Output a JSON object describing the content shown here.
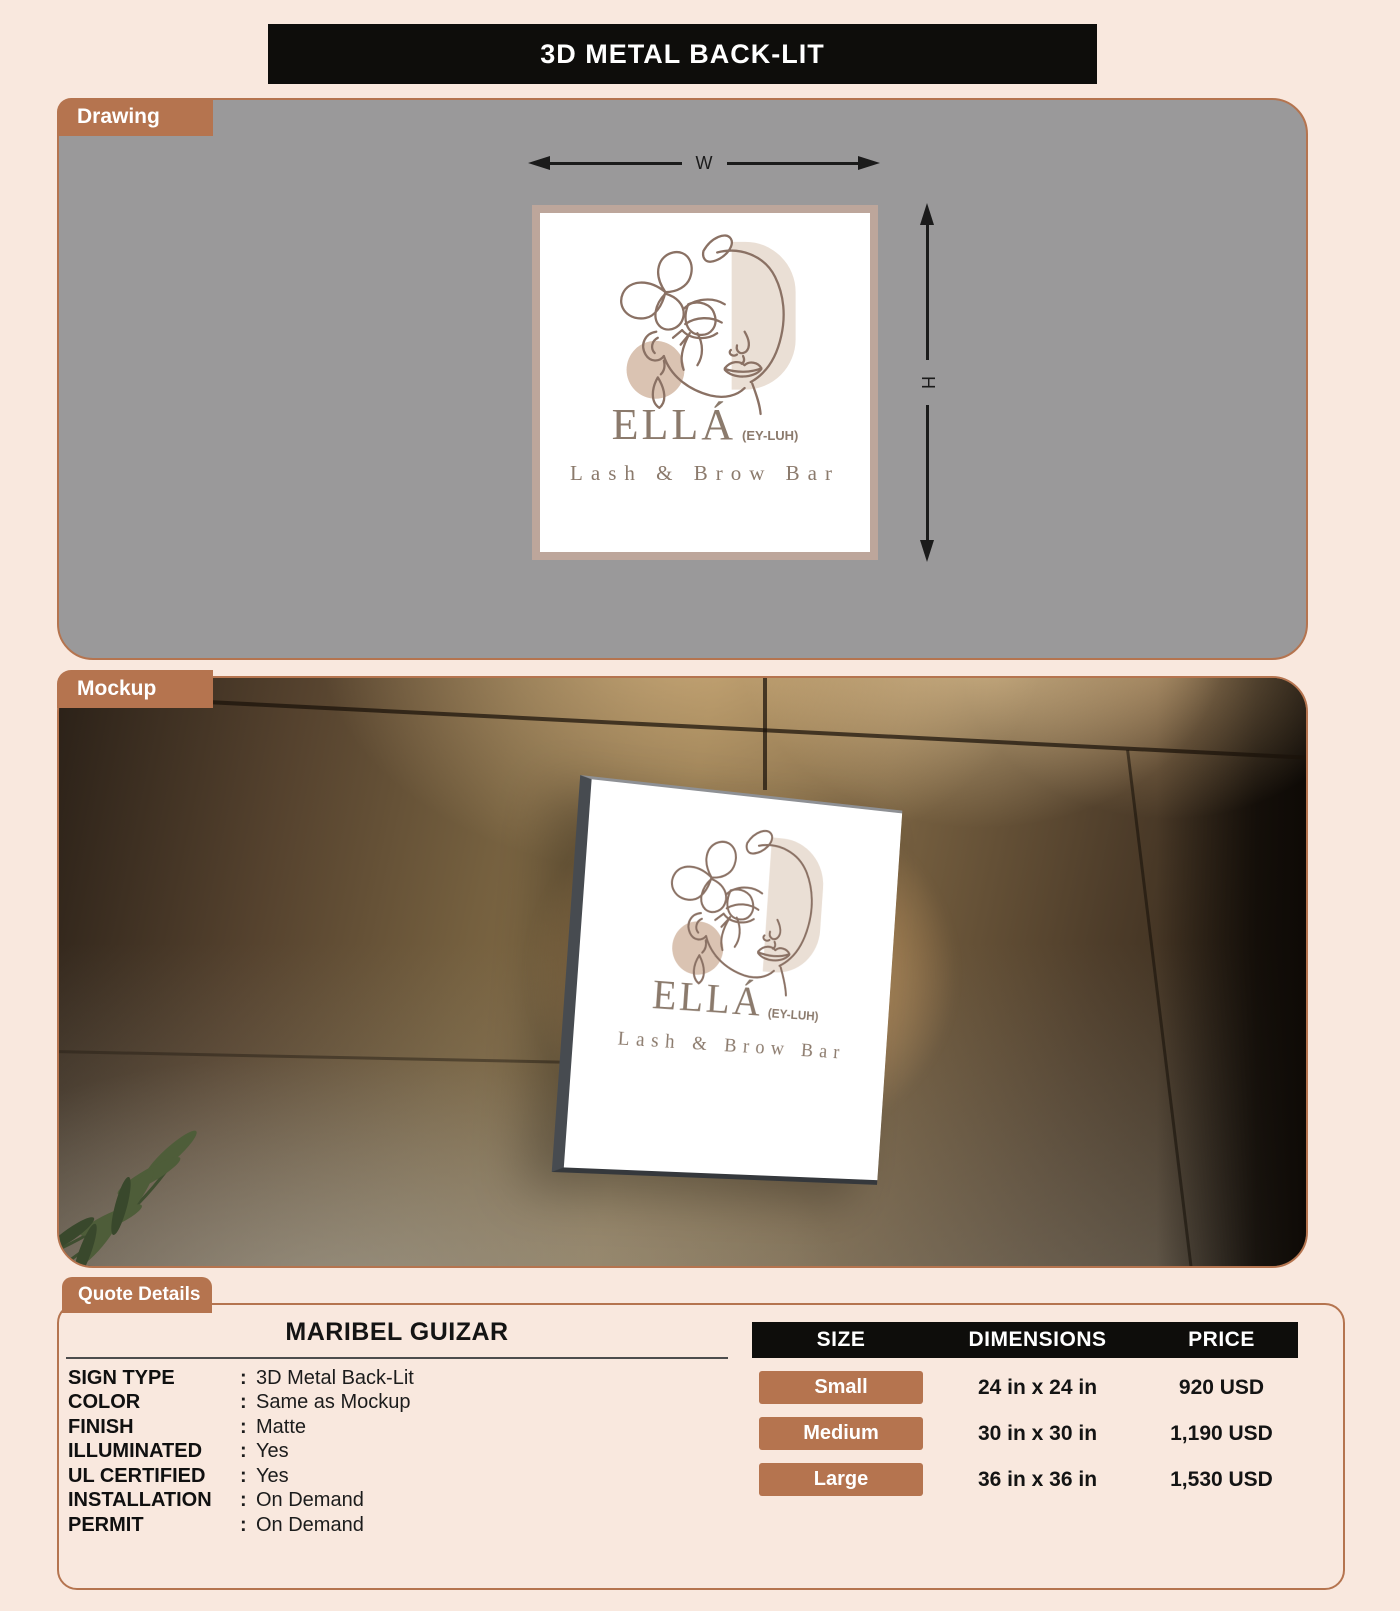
{
  "colors": {
    "page_bg": "#f9e8de",
    "accent_brown": "#b5744f",
    "header_bg": "#0e0d0b",
    "drawing_panel_bg": "#9a999a",
    "sign_border": "#bda69b",
    "logo_line": "#8a7164",
    "logo_capsule": "#eadfd5",
    "logo_circle": "#dac3b2",
    "logo_text": "#8b7a6c"
  },
  "header": {
    "title": "3D METAL BACK-LIT"
  },
  "drawing_section": {
    "tab_label": "Drawing",
    "width_label": "W",
    "height_label": "H"
  },
  "mockup_section": {
    "tab_label": "Mockup"
  },
  "sign": {
    "brand": "ELLÁ",
    "pronunciation": "(EY-LUH)",
    "tagline": "Lash & Brow Bar"
  },
  "quote": {
    "tab_label": "Quote Details",
    "customer_name": "MARIBEL GUIZAR",
    "separator": ":",
    "specs": [
      {
        "label": "SIGN TYPE",
        "value": "3D Metal Back-Lit"
      },
      {
        "label": "COLOR",
        "value": "Same as Mockup"
      },
      {
        "label": "FINISH",
        "value": "Matte"
      },
      {
        "label": "ILLUMINATED",
        "value": "Yes"
      },
      {
        "label": "UL CERTIFIED",
        "value": "Yes"
      },
      {
        "label": "INSTALLATION",
        "value": "On Demand"
      },
      {
        "label": "PERMIT",
        "value": "On Demand"
      }
    ],
    "pricing": {
      "columns": [
        "SIZE",
        "DIMENSIONS",
        "PRICE"
      ],
      "rows": [
        {
          "size": "Small",
          "dimensions": "24 in x 24 in",
          "price": "920 USD"
        },
        {
          "size": "Medium",
          "dimensions": "30 in x 30 in",
          "price": "1,190 USD"
        },
        {
          "size": "Large",
          "dimensions": "36 in x 36 in",
          "price": "1,530 USD"
        }
      ]
    }
  }
}
